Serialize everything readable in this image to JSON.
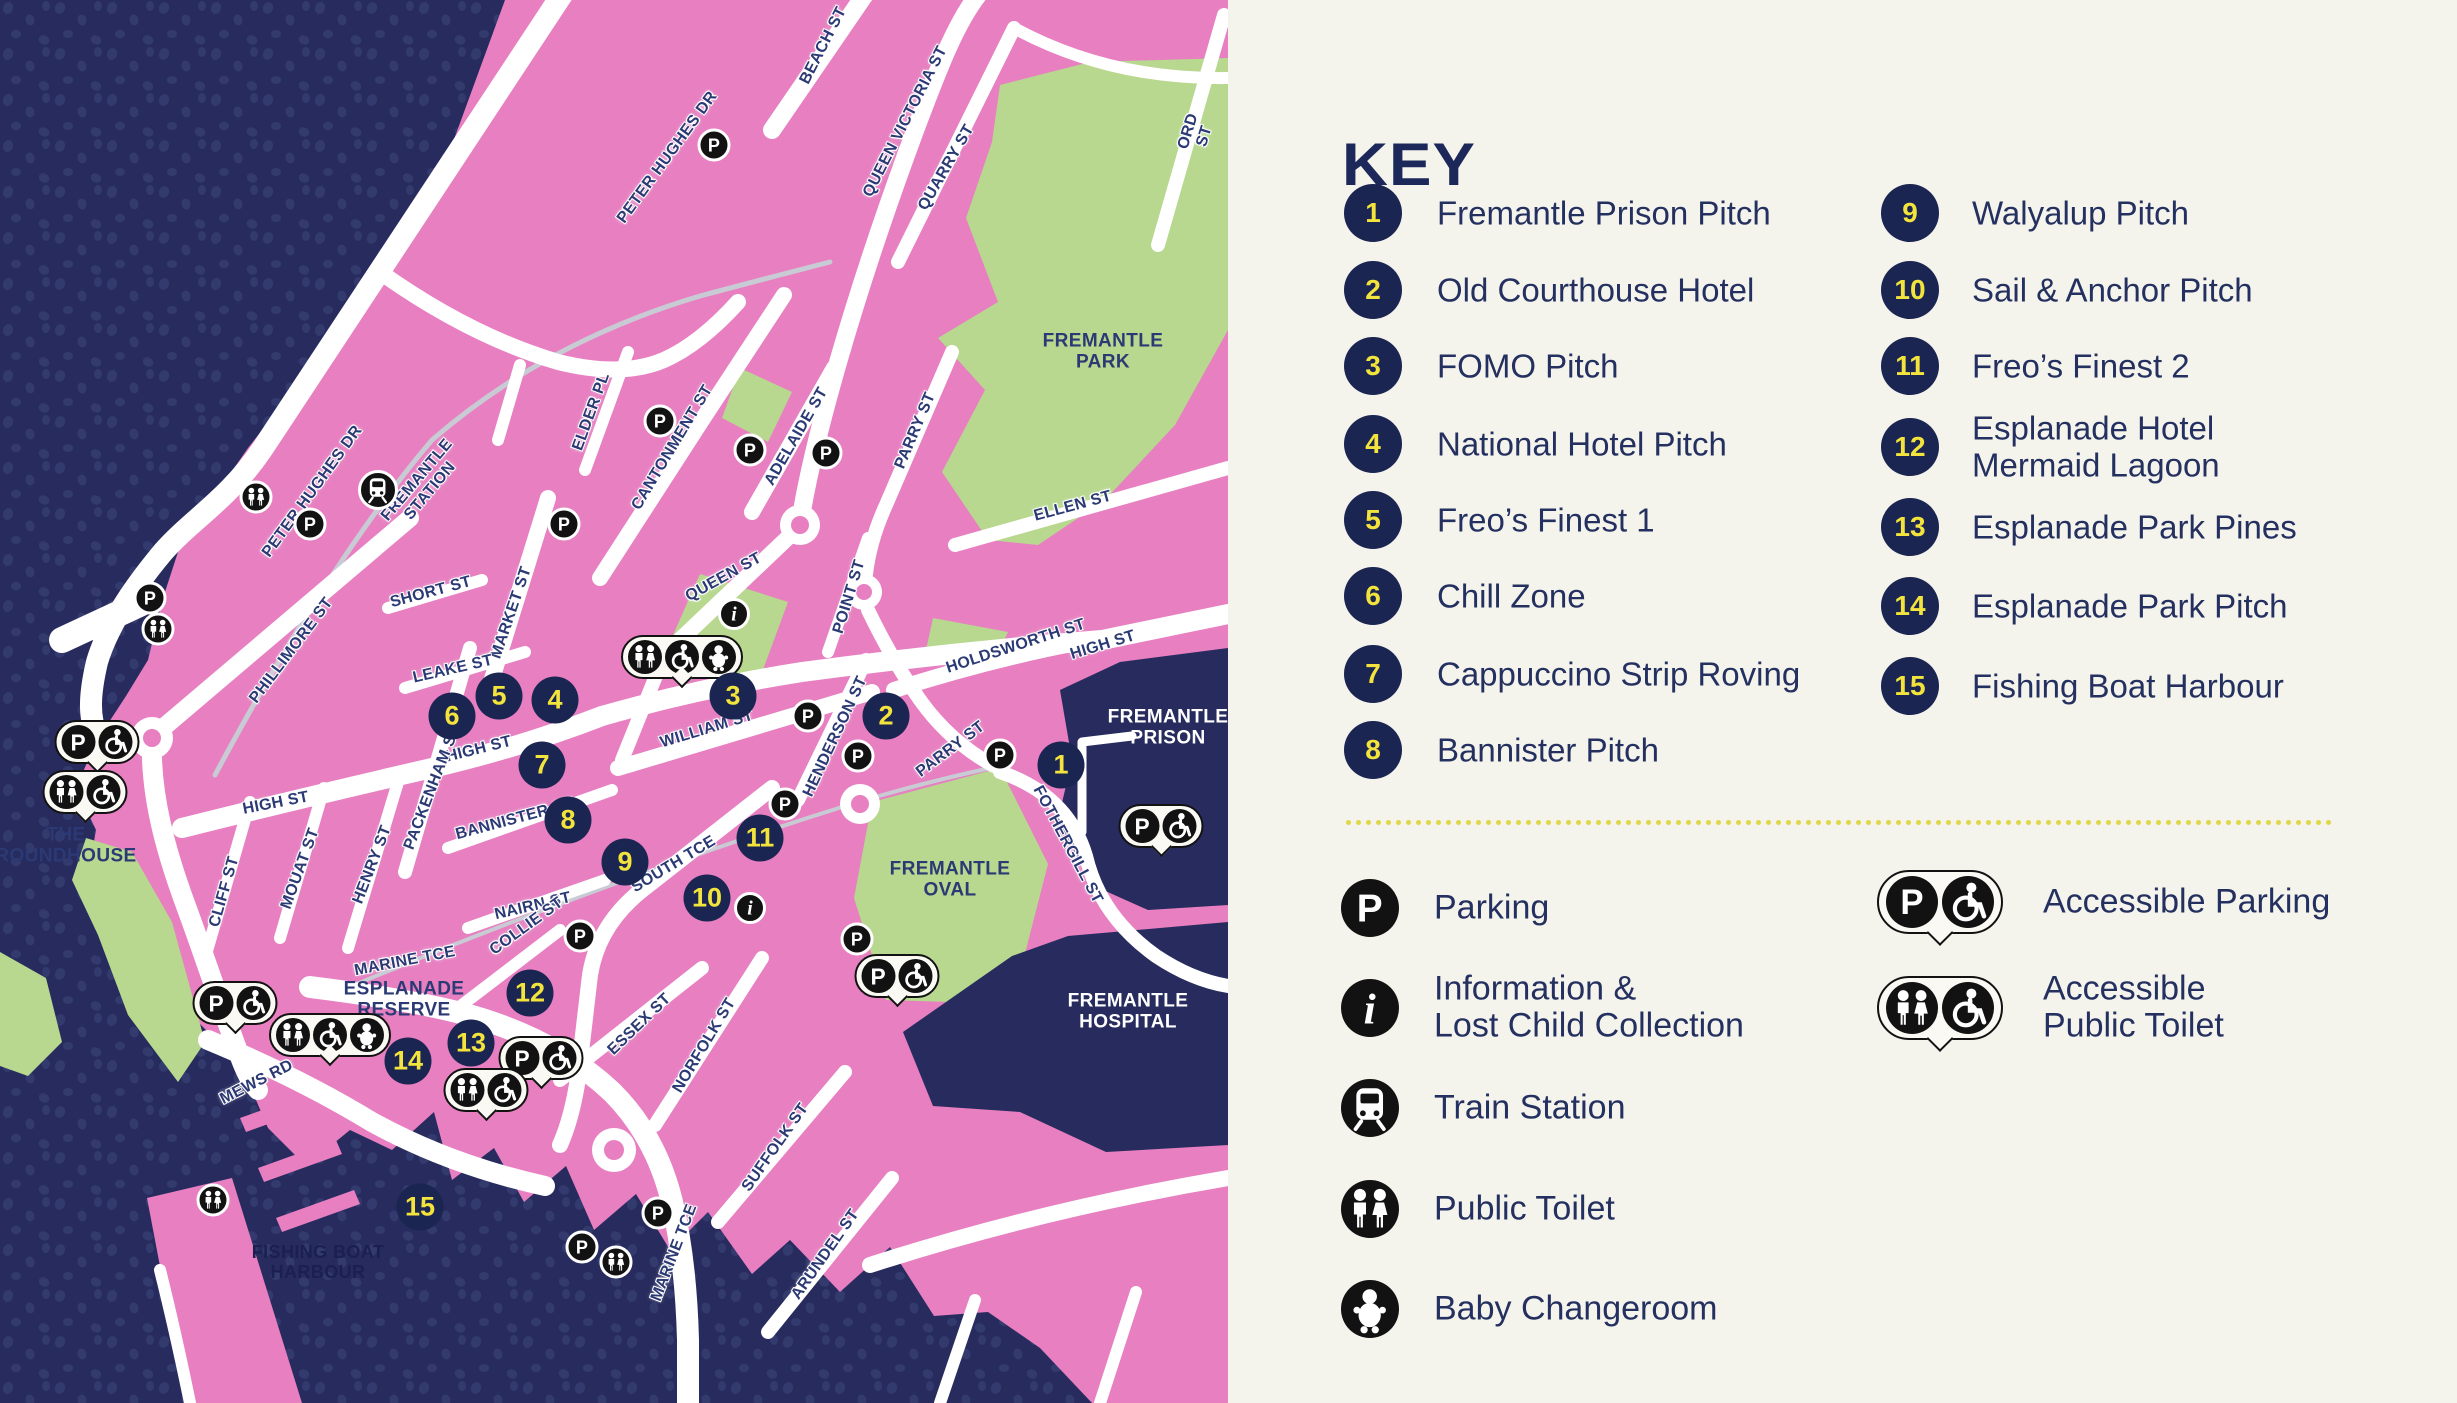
{
  "title": "Fremantle event map",
  "colors": {
    "land_pink": "#e77fc1",
    "water_navy": "#272b5e",
    "water_dots": "#333a6e",
    "park_green": "#b7d88e",
    "road_white": "#ffffff",
    "panel_bg": "#f4f3ec",
    "navy_text": "#24305f",
    "marker_navy": "#1b2551",
    "marker_yellow": "#f2e43d",
    "icon_black": "#121212",
    "divider_yellow": "#e0d747"
  },
  "key": {
    "title": "KEY",
    "items": [
      {
        "num": "1",
        "label": "Fremantle Prison Pitch"
      },
      {
        "num": "2",
        "label": "Old Courthouse Hotel"
      },
      {
        "num": "3",
        "label": "FOMO Pitch"
      },
      {
        "num": "4",
        "label": "National Hotel Pitch"
      },
      {
        "num": "5",
        "label": "Freo’s Finest 1"
      },
      {
        "num": "6",
        "label": "Chill Zone"
      },
      {
        "num": "7",
        "label": "Cappuccino Strip Roving"
      },
      {
        "num": "8",
        "label": "Bannister Pitch"
      },
      {
        "num": "9",
        "label": "Walyalup Pitch"
      },
      {
        "num": "10",
        "label": "Sail & Anchor Pitch"
      },
      {
        "num": "11",
        "label": "Freo’s Finest 2"
      },
      {
        "num": "12",
        "label": "Esplanade Hotel\nMermaid Lagoon"
      },
      {
        "num": "13",
        "label": "Esplanade Park Pines"
      },
      {
        "num": "14",
        "label": "Esplanade Park Pitch"
      },
      {
        "num": "15",
        "label": "Fishing Boat Harbour"
      }
    ],
    "legend_left": [
      {
        "icon": "p",
        "label": "Parking"
      },
      {
        "icon": "info",
        "label": "Information &\nLost Child Collection"
      },
      {
        "icon": "train",
        "label": "Train Station"
      },
      {
        "icon": "toilet",
        "label": "Public Toilet"
      },
      {
        "icon": "baby",
        "label": "Baby Changeroom"
      }
    ],
    "legend_right": [
      {
        "icons": [
          "p",
          "wheel"
        ],
        "label": "Accessible Parking"
      },
      {
        "icons": [
          "toilet",
          "wheel"
        ],
        "label": "Accessible\nPublic Toilet"
      }
    ]
  },
  "map": {
    "area_labels": [
      {
        "t": "FREMANTLE\nPARK",
        "x": 1103,
        "y": 352,
        "c": "land"
      },
      {
        "t": "THE\nROUNDHOUSE",
        "x": 66,
        "y": 846,
        "c": "land"
      },
      {
        "t": "ESPLANADE\nRESERVE",
        "x": 404,
        "y": 1000,
        "c": "land"
      },
      {
        "t": "FREMANTLE\nOVAL",
        "x": 950,
        "y": 880,
        "c": "land"
      },
      {
        "t": "FREMANTLE\nPRISON",
        "x": 1168,
        "y": 728,
        "c": "white"
      },
      {
        "t": "FREMANTLE\nHOSPITAL",
        "x": 1128,
        "y": 1012,
        "c": "white"
      },
      {
        "t": "FISHING BOAT\nHARBOUR",
        "x": 318,
        "y": 1262,
        "c": "water"
      }
    ],
    "street_labels": [
      {
        "t": "PETER HUGHES DR",
        "x": 668,
        "y": 158,
        "r": -54
      },
      {
        "t": "PETER HUGHES DR",
        "x": 313,
        "y": 492,
        "r": -54
      },
      {
        "t": "FREMANTLE\nSTATION",
        "x": 424,
        "y": 486,
        "r": -50
      },
      {
        "t": "ELDER PL",
        "x": 592,
        "y": 412,
        "r": -70
      },
      {
        "t": "BEACH ST",
        "x": 824,
        "y": 46,
        "r": -63
      },
      {
        "t": "QUEEN VICTORIA ST",
        "x": 906,
        "y": 122,
        "r": -63
      },
      {
        "t": "QUARRY ST",
        "x": 947,
        "y": 168,
        "r": -60
      },
      {
        "t": "ORD ST",
        "x": 1197,
        "y": 134,
        "r": -73
      },
      {
        "t": "CANTONMENT ST",
        "x": 673,
        "y": 448,
        "r": -59
      },
      {
        "t": "ADELAIDE ST",
        "x": 797,
        "y": 437,
        "r": -60
      },
      {
        "t": "POINT ST",
        "x": 850,
        "y": 597,
        "r": -73
      },
      {
        "t": "PARRY ST",
        "x": 916,
        "y": 431,
        "r": -67
      },
      {
        "t": "ELLEN ST",
        "x": 1073,
        "y": 507,
        "r": -15
      },
      {
        "t": "HIGH ST",
        "x": 1103,
        "y": 646,
        "r": -17
      },
      {
        "t": "HOLDSWORTH ST",
        "x": 1016,
        "y": 647,
        "r": -18
      },
      {
        "t": "QUEEN ST",
        "x": 724,
        "y": 578,
        "r": -29
      },
      {
        "t": "WILLIAM ST",
        "x": 707,
        "y": 730,
        "r": -17
      },
      {
        "t": "MARKET ST",
        "x": 512,
        "y": 613,
        "r": -71
      },
      {
        "t": "SHORT ST",
        "x": 431,
        "y": 593,
        "r": -15
      },
      {
        "t": "LEAKE ST",
        "x": 453,
        "y": 670,
        "r": -13
      },
      {
        "t": "HIGH ST",
        "x": 479,
        "y": 750,
        "r": -14
      },
      {
        "t": "PACKENHAM ST",
        "x": 433,
        "y": 788,
        "r": -69
      },
      {
        "t": "HENRY ST",
        "x": 373,
        "y": 865,
        "r": -69
      },
      {
        "t": "MOUAT ST",
        "x": 301,
        "y": 869,
        "r": -70
      },
      {
        "t": "CLIFF ST",
        "x": 225,
        "y": 892,
        "r": -74
      },
      {
        "t": "HIGH ST",
        "x": 276,
        "y": 804,
        "r": -11
      },
      {
        "t": "PHILLIMORE ST",
        "x": 292,
        "y": 651,
        "r": -53
      },
      {
        "t": "BANNISTER ST",
        "x": 515,
        "y": 820,
        "r": -15
      },
      {
        "t": "NAIRN ST",
        "x": 533,
        "y": 907,
        "r": -13
      },
      {
        "t": "COLLIE ST",
        "x": 527,
        "y": 927,
        "r": -36
      },
      {
        "t": "SOUTH TCE",
        "x": 674,
        "y": 865,
        "r": -31
      },
      {
        "t": "ESSEX ST",
        "x": 640,
        "y": 1025,
        "r": -44
      },
      {
        "t": "NORFOLK ST",
        "x": 705,
        "y": 1046,
        "r": -59
      },
      {
        "t": "SUFFOLK ST",
        "x": 776,
        "y": 1148,
        "r": -55
      },
      {
        "t": "ARUNDEL ST",
        "x": 826,
        "y": 1255,
        "r": -55
      },
      {
        "t": "MARINE TCE",
        "x": 405,
        "y": 962,
        "r": -11
      },
      {
        "t": "MARINE TCE",
        "x": 675,
        "y": 1253,
        "r": -69
      },
      {
        "t": "MEWS RD",
        "x": 257,
        "y": 1083,
        "r": -27
      },
      {
        "t": "HENDERSON ST",
        "x": 836,
        "y": 737,
        "r": -65
      },
      {
        "t": "FOTHERGILL ST",
        "x": 1067,
        "y": 845,
        "r": 62
      },
      {
        "t": "PARRY ST",
        "x": 951,
        "y": 750,
        "r": -37
      }
    ],
    "markers": [
      {
        "n": "1",
        "x": 1061,
        "y": 765
      },
      {
        "n": "2",
        "x": 886,
        "y": 716
      },
      {
        "n": "3",
        "x": 733,
        "y": 696
      },
      {
        "n": "4",
        "x": 555,
        "y": 700
      },
      {
        "n": "5",
        "x": 499,
        "y": 696
      },
      {
        "n": "6",
        "x": 452,
        "y": 716
      },
      {
        "n": "7",
        "x": 542,
        "y": 765
      },
      {
        "n": "8",
        "x": 568,
        "y": 820
      },
      {
        "n": "9",
        "x": 625,
        "y": 862
      },
      {
        "n": "10",
        "x": 707,
        "y": 898
      },
      {
        "n": "11",
        "x": 760,
        "y": 838
      },
      {
        "n": "12",
        "x": 530,
        "y": 993
      },
      {
        "n": "13",
        "x": 471,
        "y": 1043
      },
      {
        "n": "14",
        "x": 408,
        "y": 1061
      },
      {
        "n": "15",
        "x": 420,
        "y": 1207
      }
    ],
    "icons": [
      {
        "t": "p",
        "x": 714,
        "y": 145
      },
      {
        "t": "p",
        "x": 660,
        "y": 421
      },
      {
        "t": "p",
        "x": 750,
        "y": 450
      },
      {
        "t": "p",
        "x": 826,
        "y": 453
      },
      {
        "t": "p",
        "x": 564,
        "y": 524
      },
      {
        "t": "p",
        "x": 310,
        "y": 524
      },
      {
        "t": "p",
        "x": 150,
        "y": 598
      },
      {
        "t": "p",
        "x": 808,
        "y": 716
      },
      {
        "t": "p",
        "x": 858,
        "y": 756
      },
      {
        "t": "p",
        "x": 1000,
        "y": 755
      },
      {
        "t": "p",
        "x": 785,
        "y": 804
      },
      {
        "t": "p",
        "x": 857,
        "y": 939
      },
      {
        "t": "p",
        "x": 580,
        "y": 936
      },
      {
        "t": "p",
        "x": 658,
        "y": 1213
      },
      {
        "t": "p",
        "x": 582,
        "y": 1247
      },
      {
        "t": "toilet",
        "x": 256,
        "y": 497
      },
      {
        "t": "toilet",
        "x": 158,
        "y": 629
      },
      {
        "t": "toilet",
        "x": 213,
        "y": 1200
      },
      {
        "t": "toilet",
        "x": 616,
        "y": 1262
      },
      {
        "t": "train",
        "x": 378,
        "y": 490
      },
      {
        "t": "info",
        "x": 734,
        "y": 614
      },
      {
        "t": "info",
        "x": 750,
        "y": 908
      }
    ],
    "bubbles": [
      {
        "icons": [
          "p",
          "wheel"
        ],
        "x": 97,
        "y": 742
      },
      {
        "icons": [
          "p",
          "wheel"
        ],
        "x": 235,
        "y": 1003
      },
      {
        "icons": [
          "p",
          "wheel"
        ],
        "x": 541,
        "y": 1058
      },
      {
        "icons": [
          "p",
          "wheel"
        ],
        "x": 1161,
        "y": 826
      },
      {
        "icons": [
          "p",
          "wheel"
        ],
        "x": 897,
        "y": 976
      },
      {
        "icons": [
          "toilet",
          "wheel"
        ],
        "x": 85,
        "y": 792
      },
      {
        "icons": [
          "toilet",
          "wheel"
        ],
        "x": 486,
        "y": 1090
      },
      {
        "icons": [
          "toilet",
          "wheel",
          "baby"
        ],
        "x": 682,
        "y": 657
      },
      {
        "icons": [
          "toilet",
          "wheel",
          "baby"
        ],
        "x": 330,
        "y": 1035
      }
    ]
  }
}
